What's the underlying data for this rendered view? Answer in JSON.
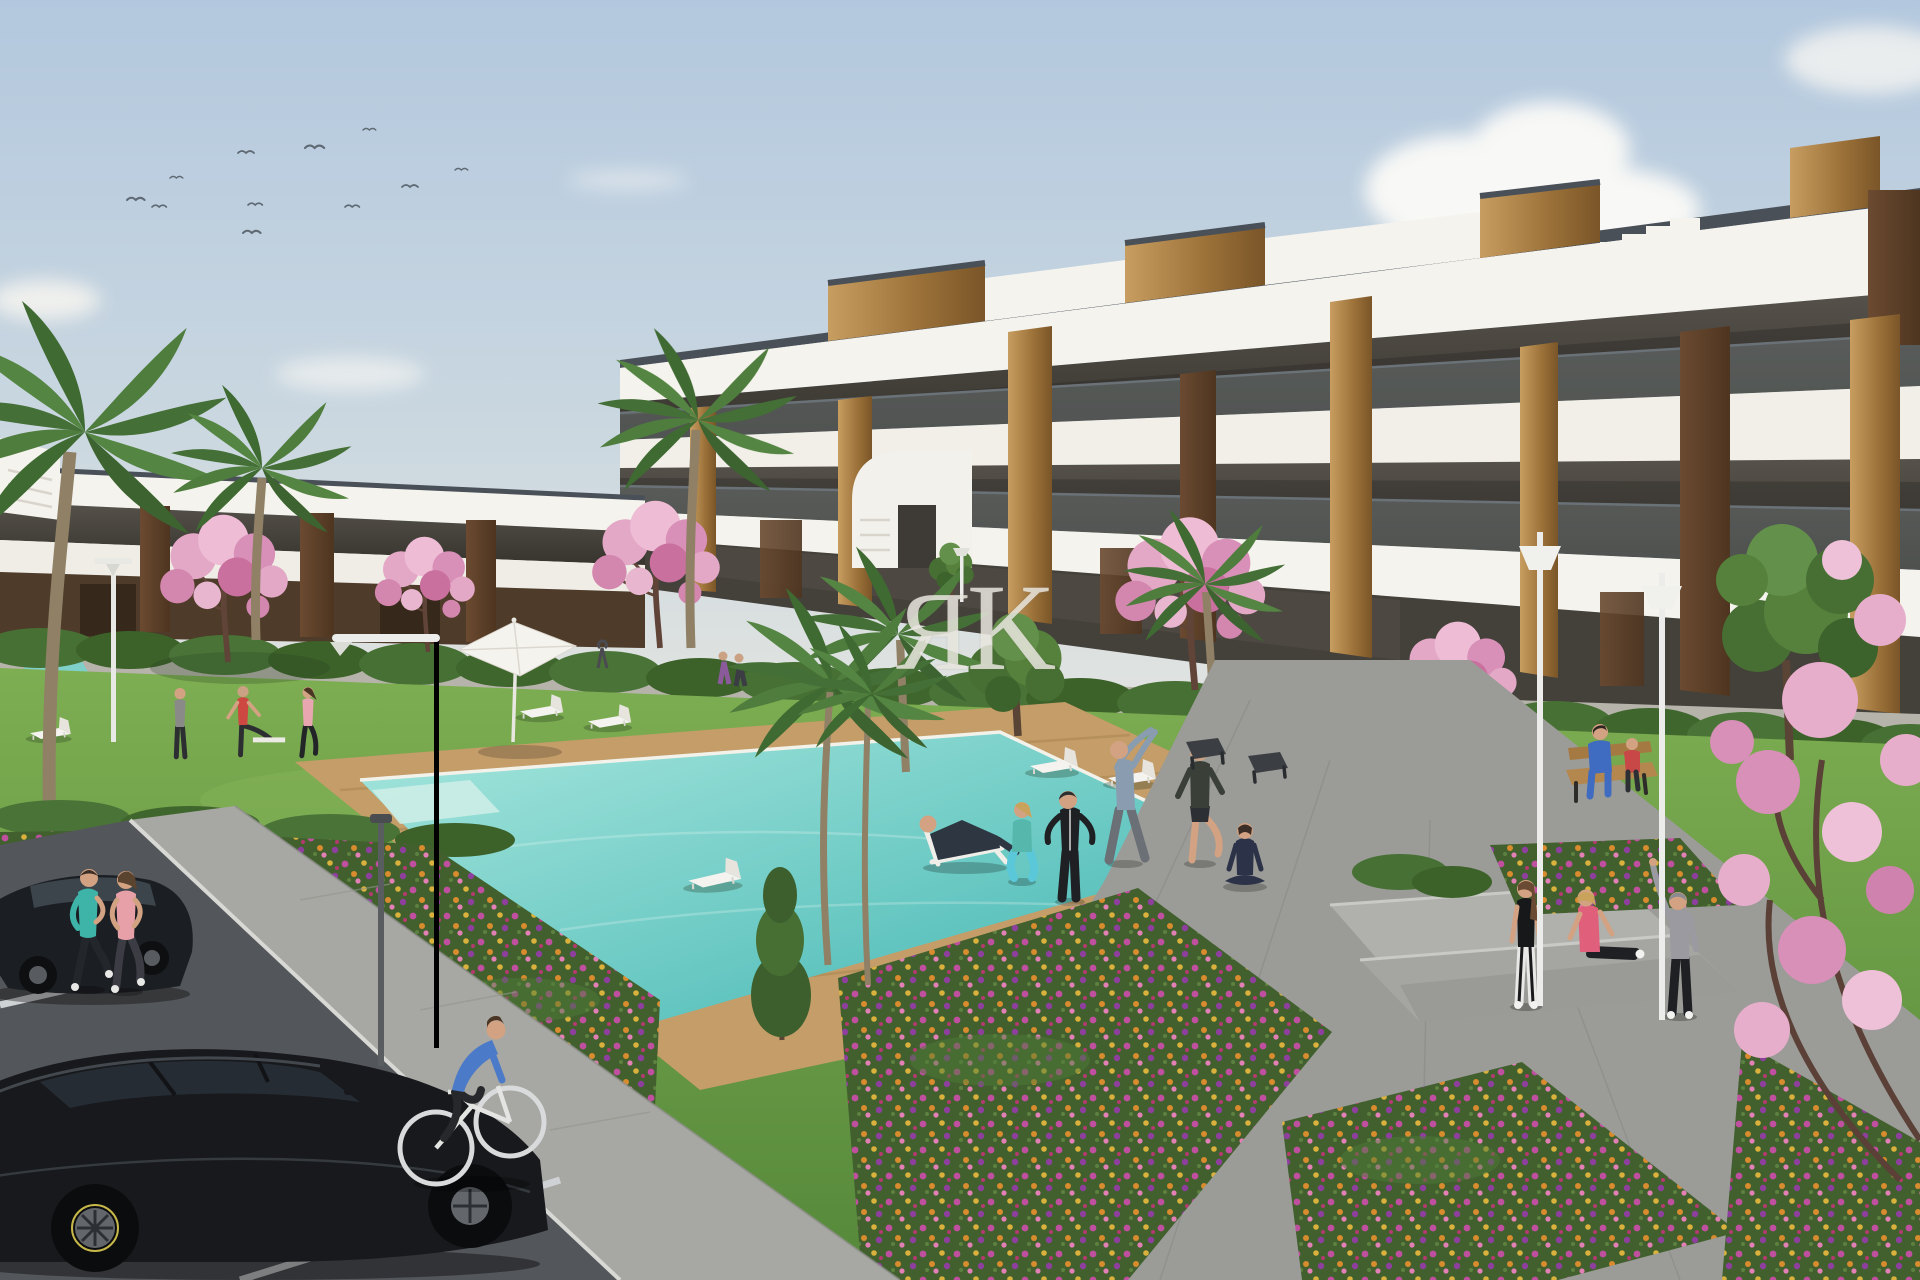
{
  "image": {
    "type": "3d-architectural-render",
    "width_px": 1920,
    "height_px": 1280,
    "subject": "New-build white residential apartment complex with communal pool, landscaped gardens, street parking and residents outdoors"
  },
  "watermark": {
    "letters": [
      "Я",
      "K"
    ]
  },
  "palette": {
    "sky_top": "#b3c8de",
    "sky_horizon": "#e2e4e0",
    "cloud": "#fbfaf7",
    "building_white": "#f5f3ed",
    "building_shade": "#e3dfd6",
    "roof_rail": "#4a5058",
    "glass_dark": "#3f3c36",
    "wood_light": "#c79d60",
    "wood_dark": "#6b4a30",
    "lawn_light": "#7eae52",
    "lawn_dark": "#55883a",
    "hedge_green": "#477034",
    "pool_shallow": "#a5e6dd",
    "pool_deep": "#3fb3b0",
    "deck_wood": "#c49d69",
    "path_gray": "#9b9b97",
    "asphalt": "#53565a",
    "car_black": "#17191c",
    "blossom_pink": "#e3a8c6",
    "palm_green": "#4f7d3e",
    "flower_magenta": "#c04fa0",
    "flower_orange": "#d88c2e",
    "flower_yellow": "#d9b13c",
    "flower_purple": "#8e3f9e",
    "watermark_gray": "#edeae3"
  },
  "inventory": {
    "birds": 11,
    "street_lamps": 6,
    "sun_loungers": 10,
    "parasols": 1,
    "benches": 3,
    "parked_cars": 2,
    "bicycles": 1,
    "pool": {
      "main_pool": true,
      "jacuzzi": true,
      "wooden_deck": true
    },
    "buildings": {
      "left_wing_floors": 2,
      "main_wing_floors": 3,
      "style": "white modern blocks, glass balcony rails, vertical wood cladding, rooftop wooden volumes"
    },
    "vegetation": {
      "palm_trees": 7,
      "pink_blossom_trees": 6,
      "green_trees": 3,
      "flower_beds": 5,
      "hedges": "along building base, paths and lawn edges"
    },
    "people": [
      "woman jogging in teal top (left sidewalk)",
      "woman jogging in pink top (left sidewalk)",
      "man in gray shirt on left lawn",
      "man in red shirt stretching on left lawn",
      "woman in pink top on left lawn",
      "man reclining on deck chair",
      "woman squatting in turquoise leggings",
      "person in black tracksuit",
      "man in blue-gray top doing side stretch",
      "man in dark top and shorts exercising",
      "woman seated cross-legged doing yoga",
      "two people sitting on wooden bench",
      "woman in black tank top standing on path",
      "woman in pink top sitting on steps",
      "woman in gray hoodie with arm raised",
      "man in blue sweater riding bicycle",
      "three small background figures on rear walkway"
    ]
  }
}
